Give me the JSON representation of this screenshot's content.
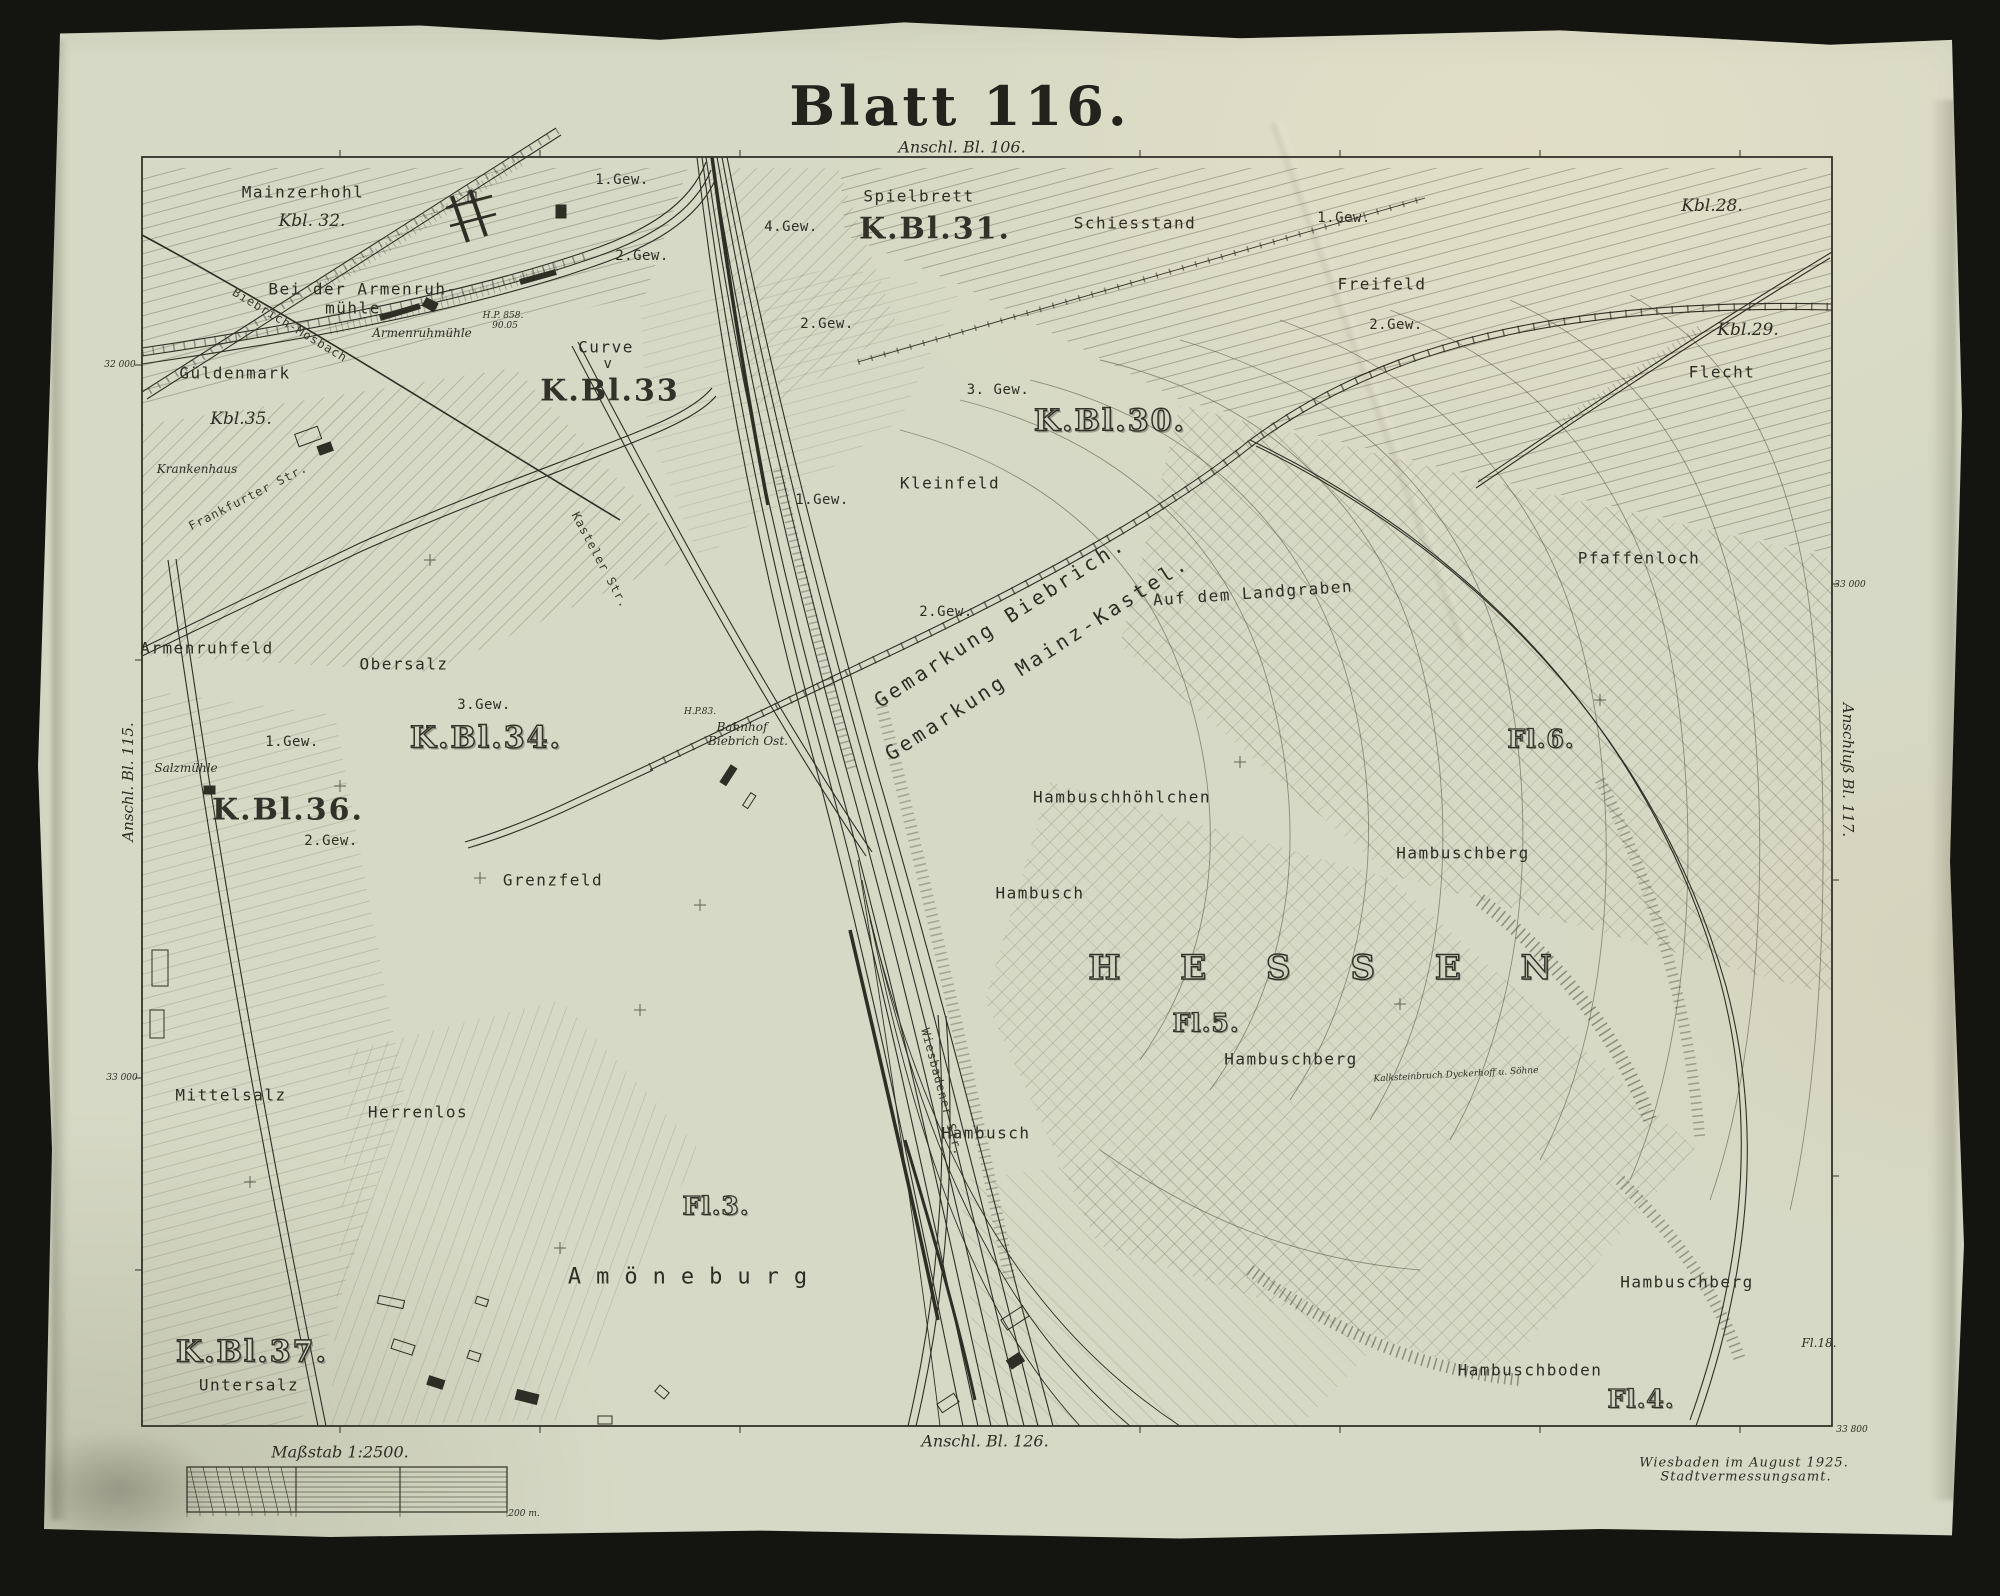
{
  "sheet": {
    "title": "Blatt 116.",
    "scale_caption": "Maßstab 1:2500.",
    "scale_end_label": "200 m.",
    "imprint_line1": "Wiesbaden im August 1925.",
    "imprint_line2": "Stadtvermessungsamt.",
    "adjoining": {
      "top": "Anschl. Bl. 106.",
      "bottom": "Anschl. Bl. 126.",
      "left": "Anschl. Bl. 115.",
      "right": "Anschluß Bl. 117."
    }
  },
  "colors": {
    "paper": "#d6d9c5",
    "ink": "#2e2d25",
    "scan_background": "#141410"
  },
  "labels": [
    {
      "t": "Mainzerhohl",
      "x": 303,
      "y": 192,
      "c": "f"
    },
    {
      "t": "Kbl. 32.",
      "x": 312,
      "y": 221,
      "c": "i"
    },
    {
      "t": "Bei der Armenruh-",
      "x": 363,
      "y": 289,
      "c": "f"
    },
    {
      "t": "mühle",
      "x": 353,
      "y": 308,
      "c": "f"
    },
    {
      "t": "Armenruhmühle",
      "x": 422,
      "y": 333,
      "c": "is"
    },
    {
      "t": "Biebrich-Mosbach",
      "x": 290,
      "y": 325,
      "c": "rd",
      "r": 31
    },
    {
      "t": "1.Gew.",
      "x": 622,
      "y": 180,
      "c": "g"
    },
    {
      "t": "2.Gew.",
      "x": 642,
      "y": 256,
      "c": "g"
    },
    {
      "t": "Curve",
      "x": 606,
      "y": 347,
      "c": "f"
    },
    {
      "t": "v",
      "x": 608,
      "y": 364,
      "c": "g"
    },
    {
      "t": "K.Bl.33",
      "x": 610,
      "y": 391,
      "c": "k"
    },
    {
      "t": "H.P. 858.",
      "x": 503,
      "y": 316,
      "c": "t"
    },
    {
      "t": "90.05",
      "x": 505,
      "y": 326,
      "c": "t"
    },
    {
      "t": "4.Gew.",
      "x": 791,
      "y": 227,
      "c": "g"
    },
    {
      "t": "2.Gew.",
      "x": 827,
      "y": 324,
      "c": "g"
    },
    {
      "t": "Spielbrett",
      "x": 919,
      "y": 196,
      "c": "f"
    },
    {
      "t": "K.Bl.31.",
      "x": 935,
      "y": 229,
      "c": "k"
    },
    {
      "t": "Schiesstand",
      "x": 1135,
      "y": 223,
      "c": "f"
    },
    {
      "t": "1.Gew.",
      "x": 1344,
      "y": 218,
      "c": "g"
    },
    {
      "t": "Freifeld",
      "x": 1382,
      "y": 284,
      "c": "f"
    },
    {
      "t": "2.Gew.",
      "x": 1396,
      "y": 325,
      "c": "g"
    },
    {
      "t": "Kbl.28.",
      "x": 1712,
      "y": 206,
      "c": "i"
    },
    {
      "t": "Kbl.29.",
      "x": 1748,
      "y": 330,
      "c": "i"
    },
    {
      "t": "Flecht",
      "x": 1722,
      "y": 372,
      "c": "f"
    },
    {
      "t": "3. Gew.",
      "x": 998,
      "y": 390,
      "c": "g"
    },
    {
      "t": "K.Bl.30.",
      "x": 1110,
      "y": 421,
      "c": "ko"
    },
    {
      "t": "Kleinfeld",
      "x": 950,
      "y": 483,
      "c": "f"
    },
    {
      "t": "1.Gew.",
      "x": 822,
      "y": 500,
      "c": "g"
    },
    {
      "t": "Güldenmark",
      "x": 235,
      "y": 373,
      "c": "f"
    },
    {
      "t": "Kbl.35.",
      "x": 241,
      "y": 419,
      "c": "i"
    },
    {
      "t": "Krankenhaus",
      "x": 197,
      "y": 469,
      "c": "is"
    },
    {
      "t": "Frankfurter Str.",
      "x": 248,
      "y": 497,
      "c": "rd",
      "r": -27
    },
    {
      "t": "Armenruhfeld",
      "x": 207,
      "y": 648,
      "c": "f"
    },
    {
      "t": "Obersalz",
      "x": 404,
      "y": 664,
      "c": "f"
    },
    {
      "t": "3.Gew.",
      "x": 484,
      "y": 705,
      "c": "g"
    },
    {
      "t": "K.Bl.34.",
      "x": 486,
      "y": 738,
      "c": "ko"
    },
    {
      "t": "1.Gew.",
      "x": 292,
      "y": 742,
      "c": "g"
    },
    {
      "t": "Salzmühle",
      "x": 186,
      "y": 768,
      "c": "is"
    },
    {
      "t": "K.Bl.36.",
      "x": 288,
      "y": 810,
      "c": "k"
    },
    {
      "t": "2.Gew.",
      "x": 331,
      "y": 841,
      "c": "g"
    },
    {
      "t": "Grenzfeld",
      "x": 553,
      "y": 880,
      "c": "f"
    },
    {
      "t": "Kasteler Str.",
      "x": 600,
      "y": 560,
      "c": "rd",
      "r": 62
    },
    {
      "t": "Bahnhof",
      "x": 742,
      "y": 727,
      "c": "is"
    },
    {
      "t": "Biebrich Ost.",
      "x": 748,
      "y": 741,
      "c": "is"
    },
    {
      "t": "H.P.83.",
      "x": 700,
      "y": 712,
      "c": "t"
    },
    {
      "t": "Gemarkung Biebrich.",
      "x": 1000,
      "y": 622,
      "c": "gem",
      "r": -33
    },
    {
      "t": "Gemarkung Mainz-Kastel.",
      "x": 1037,
      "y": 658,
      "c": "gem",
      "r": -33
    },
    {
      "t": "2.Gew.",
      "x": 946,
      "y": 612,
      "c": "g"
    },
    {
      "t": "Auf dem Landgraben",
      "x": 1253,
      "y": 593,
      "c": "f",
      "r": -4
    },
    {
      "t": "Pfaffenloch",
      "x": 1639,
      "y": 558,
      "c": "f"
    },
    {
      "t": "Fl.6.",
      "x": 1541,
      "y": 739,
      "c": "fl"
    },
    {
      "t": "Hambuschhöhlchen",
      "x": 1122,
      "y": 797,
      "c": "f"
    },
    {
      "t": "Hambuschberg",
      "x": 1463,
      "y": 853,
      "c": "f"
    },
    {
      "t": "Hambusch",
      "x": 1040,
      "y": 893,
      "c": "f"
    },
    {
      "t": "H E S S E N",
      "x": 1332,
      "y": 968,
      "c": "hes"
    },
    {
      "t": "Fl.5.",
      "x": 1206,
      "y": 1023,
      "c": "fl"
    },
    {
      "t": "Hambuschberg",
      "x": 1291,
      "y": 1059,
      "c": "f"
    },
    {
      "t": "Kalksteinbruch Dyckerhoff u. Söhne",
      "x": 1456,
      "y": 1075,
      "c": "t",
      "r": -3
    },
    {
      "t": "Hambusch",
      "x": 986,
      "y": 1133,
      "c": "f"
    },
    {
      "t": "Mittelsalz",
      "x": 231,
      "y": 1095,
      "c": "f"
    },
    {
      "t": "Herrenlos",
      "x": 418,
      "y": 1112,
      "c": "f"
    },
    {
      "t": "Fl.3.",
      "x": 716,
      "y": 1206,
      "c": "fl"
    },
    {
      "t": "Amöneburg",
      "x": 695,
      "y": 1277,
      "c": "amo"
    },
    {
      "t": "Wiesbadener Str.",
      "x": 942,
      "y": 1092,
      "c": "rd",
      "r": 75
    },
    {
      "t": "K.Bl.37.",
      "x": 252,
      "y": 1352,
      "c": "ko"
    },
    {
      "t": "Untersalz",
      "x": 249,
      "y": 1385,
      "c": "f"
    },
    {
      "t": "Hambuschberg",
      "x": 1687,
      "y": 1282,
      "c": "f"
    },
    {
      "t": "Hambuschboden",
      "x": 1530,
      "y": 1370,
      "c": "f"
    },
    {
      "t": "Fl.4.",
      "x": 1641,
      "y": 1399,
      "c": "fl"
    },
    {
      "t": "Fl.18.",
      "x": 1819,
      "y": 1343,
      "c": "is"
    },
    {
      "t": "32 000",
      "x": 120,
      "y": 365,
      "c": "t"
    },
    {
      "t": "33 000",
      "x": 122,
      "y": 1078,
      "c": "t"
    },
    {
      "t": "33 000",
      "x": 1850,
      "y": 585,
      "c": "t"
    },
    {
      "t": "33 800",
      "x": 1852,
      "y": 1430,
      "c": "t"
    },
    {
      "t": "200 m.",
      "x": 524,
      "y": 1514,
      "c": "t"
    }
  ]
}
